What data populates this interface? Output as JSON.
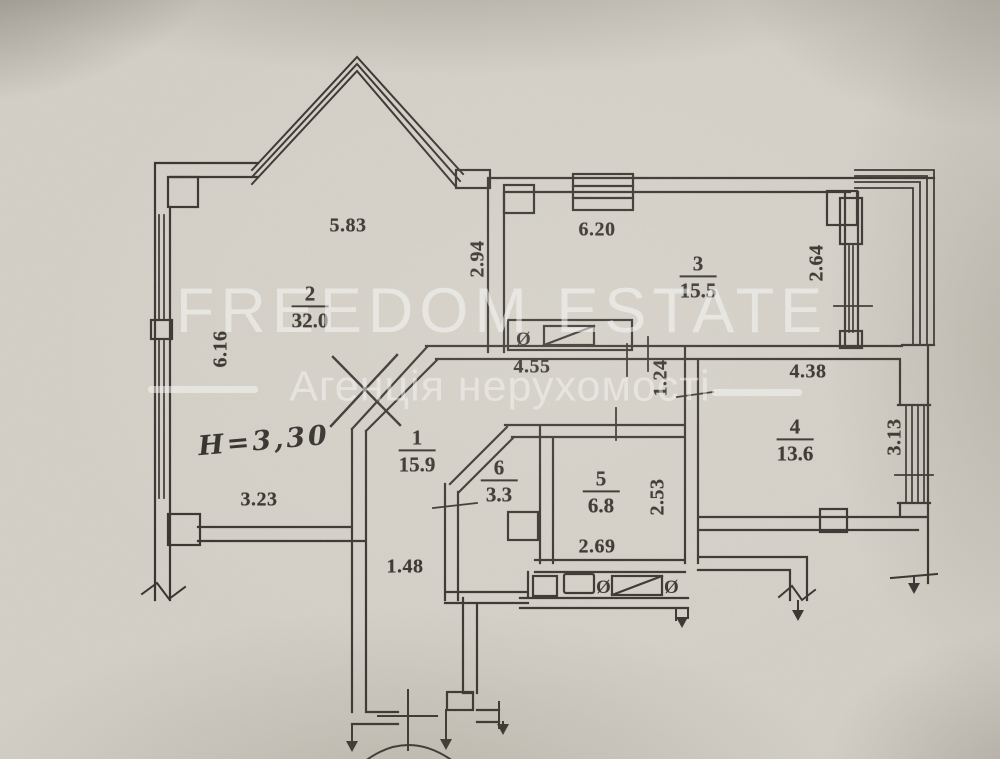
{
  "watermark": {
    "brand": "FREEDOM ESTATE",
    "tagline": "Агенція нерухомості"
  },
  "annotations": {
    "ceiling_height": "H=3,30",
    "vent_symbol": "Ø"
  },
  "rooms": [
    {
      "number": "1",
      "area": "15.9"
    },
    {
      "number": "2",
      "area": "32.0"
    },
    {
      "number": "3",
      "area": "15.5"
    },
    {
      "number": "4",
      "area": "13.6"
    },
    {
      "number": "5",
      "area": "6.8"
    },
    {
      "number": "6",
      "area": "3.3"
    }
  ],
  "dimensions": {
    "room2_top": "5.83",
    "room2_left": "6.16",
    "room2_right": "2.94",
    "room2_bottom": "3.23",
    "room3_top": "6.20",
    "room3_right": "2.64",
    "hall_top": "4.55",
    "hall_gap": "1.24",
    "hall_width": "1.48",
    "room4_top": "4.38",
    "room4_right": "3.13",
    "room5_right": "2.53",
    "room5_bottom": "2.69"
  },
  "colors": {
    "paper": "#d6d2c9",
    "ink": "#2e2b26",
    "watermark": "#ffffff"
  }
}
